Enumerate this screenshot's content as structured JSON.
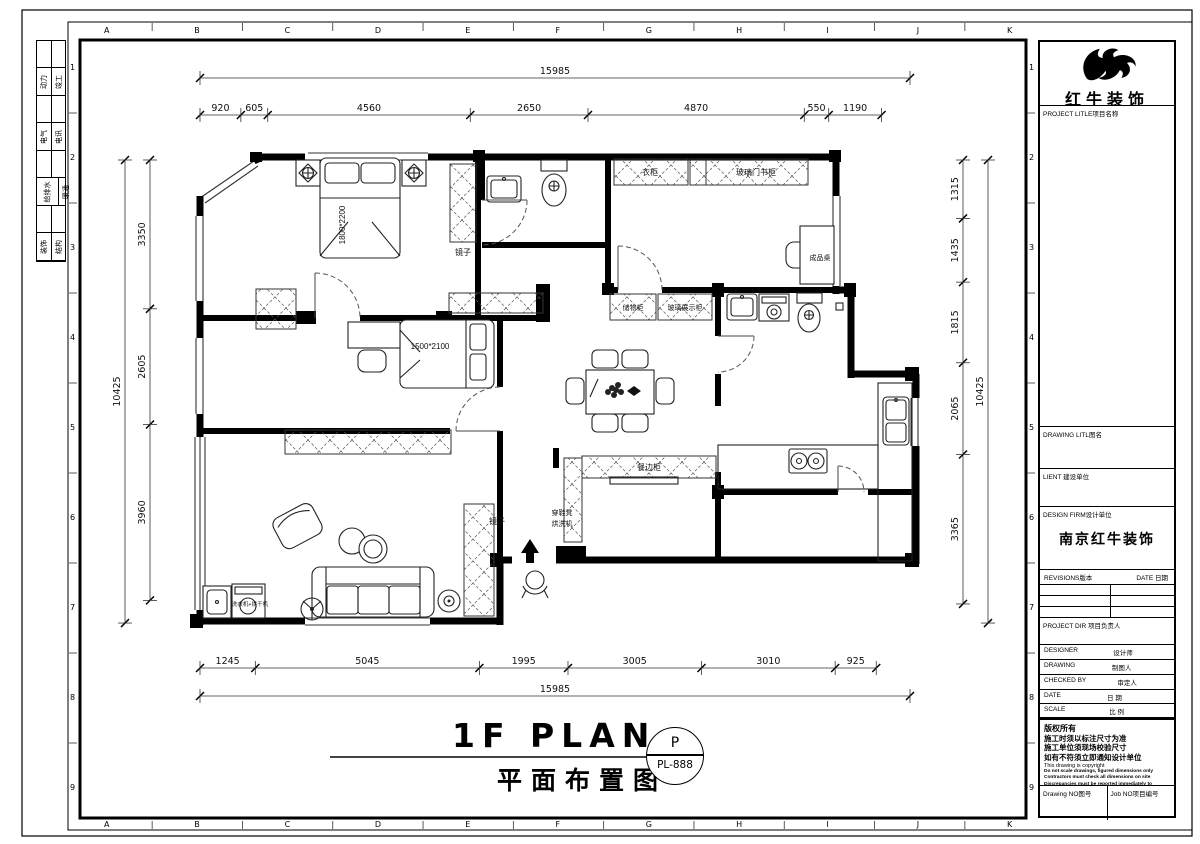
{
  "frame": {
    "grid_letters": [
      "A",
      "B",
      "C",
      "D",
      "E",
      "F",
      "G",
      "H",
      "I",
      "J",
      "K"
    ],
    "grid_numbers": [
      "1",
      "2",
      "3",
      "4",
      "5",
      "6",
      "7",
      "8",
      "9"
    ],
    "discipline_labels": [
      [
        "动力",
        "竣工"
      ],
      [
        "电气",
        "电讯"
      ],
      [
        "给排水",
        "暖通"
      ],
      [
        "装饰",
        "结构"
      ]
    ]
  },
  "title_block": {
    "company": "红牛装饰",
    "project_title_label": "PROJECT LITLE项目名称",
    "drawing_title_label": "DRAWING LITL图名",
    "client_label": "LIENT 建设单位",
    "design_firm_label": "DESIGN FIRM设计单位",
    "design_firm_value": "南京红牛装饰",
    "revisions_label": "REVISIONS版本",
    "date_col_label": "DATE 日期",
    "project_dir_label": "PROJECT DIR 项目负责人",
    "designer_label": "DESIGNER",
    "designer_cn": "设计师",
    "drawing_label": "DRAWING",
    "drawing_cn": "制图人",
    "checked_label": "CHECKED BY",
    "checked_cn": "审定人",
    "date_label": "DATE",
    "date_cn": "日 期",
    "scale_label": "SCALE",
    "scale_cn": "比 例",
    "copyright_cn": [
      "版权所有",
      "施工时须以标注尺寸为准",
      "施工单位须现场校验尺寸",
      "如有不符须立即通知设计单位"
    ],
    "copyright_en": [
      "This drawing is copyright",
      "Do not scale drawings, figured dimensions only",
      "Contractors must check all dimensions on site",
      "Discrepancies must be reported immediately to architects"
    ],
    "drawing_no_label": "Drawing NO图号",
    "job_no_label": "Job NO项目编号"
  },
  "drawing_title": {
    "en": "1F PLAN",
    "cn": "平面布置图",
    "bubble_letter": "P",
    "bubble_code": "PL-888"
  },
  "dims": {
    "top": {
      "total": "15985",
      "segments": [
        "920",
        "605",
        "4560",
        "2650",
        "4870",
        "550",
        "1190"
      ]
    },
    "bottom": {
      "total": "15985",
      "segments": [
        "1245",
        "5045",
        "1995",
        "3005",
        "3010",
        "925"
      ]
    },
    "left": {
      "total": "10425",
      "segments": [
        "3350",
        "2605",
        "3960"
      ]
    },
    "right": {
      "total": "10425",
      "segments": [
        "1315",
        "1435",
        "1815",
        "2065",
        "3365"
      ]
    }
  },
  "plan_labels": {
    "bed_master": "1800*2200",
    "bed_second": "1500*2100",
    "mirror1": "镜子",
    "mirror2": "镜子",
    "wardrobe": "衣柜",
    "glass_bookcase": "玻璃门书柜",
    "desk": "成品桌",
    "storage": "储物柜",
    "glass_display": "玻璃展示柜",
    "sideboard": "餐边柜",
    "shoe_bench": "穿鞋凳",
    "dry_wash": "烘洗机",
    "washer": "洗衣机+烘干机"
  },
  "colors": {
    "line": "#000000",
    "paper": "#ffffff"
  }
}
